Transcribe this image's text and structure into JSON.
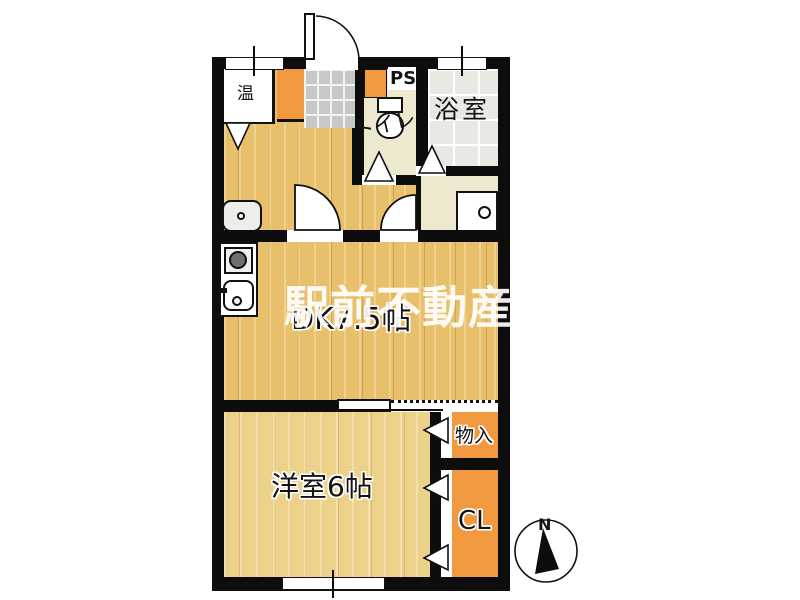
{
  "watermark": {
    "text": "駅前不動産"
  },
  "compass": {
    "north_label": "N"
  },
  "rooms": {
    "dk": "DK7.5帖",
    "western_room": "洋室6帖",
    "bathroom": "浴室",
    "toilet": "トイレ",
    "storage": "物入",
    "closet": "CL"
  },
  "fixtures": {
    "water_heater": "温",
    "pipe_space": "PS"
  },
  "colors": {
    "wall": "#0d0d0d",
    "wood_floor": "#e8c06c",
    "western_floor": "#ecd18b",
    "closet_orange": "#f0993f",
    "toilet_cream": "#ece9cf",
    "entry_tile": "#c7c7c7",
    "bath_tile": "#e9e9e3"
  }
}
